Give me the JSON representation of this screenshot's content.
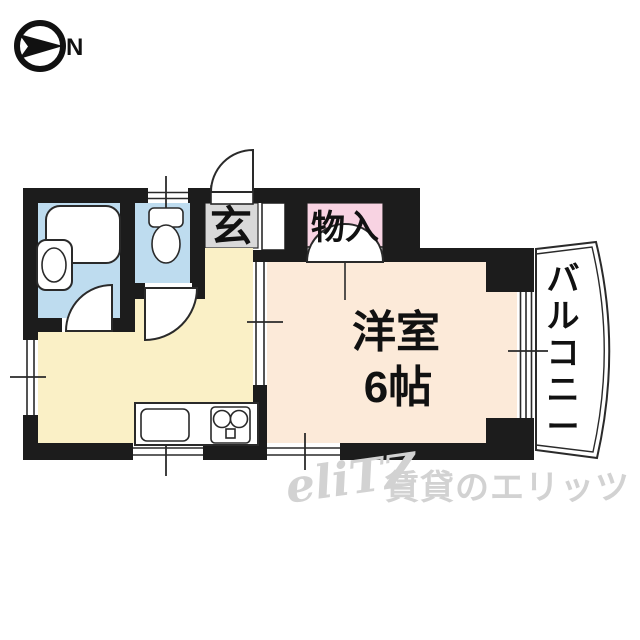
{
  "compass": {
    "north_label": "N"
  },
  "plan": {
    "labels": {
      "genkan": "玄",
      "storage": "物入",
      "main_room_line1": "洋室",
      "main_room_line2": "6帖",
      "balcony": "バルコニー"
    },
    "colors": {
      "wall": "#1c1c1c",
      "wet_area_floor": "#bedcef",
      "kitchen_floor": "#faf0c6",
      "main_room_floor": "#fcead9",
      "storage_fill": "#f8d3e2",
      "genkan_fill": "#d9d9d9",
      "balcony_fill": "#ffffff"
    }
  },
  "watermark": {
    "logo": "eliTZ",
    "text": "賃貸のエリッツ",
    "color": "#d2d2d2"
  }
}
